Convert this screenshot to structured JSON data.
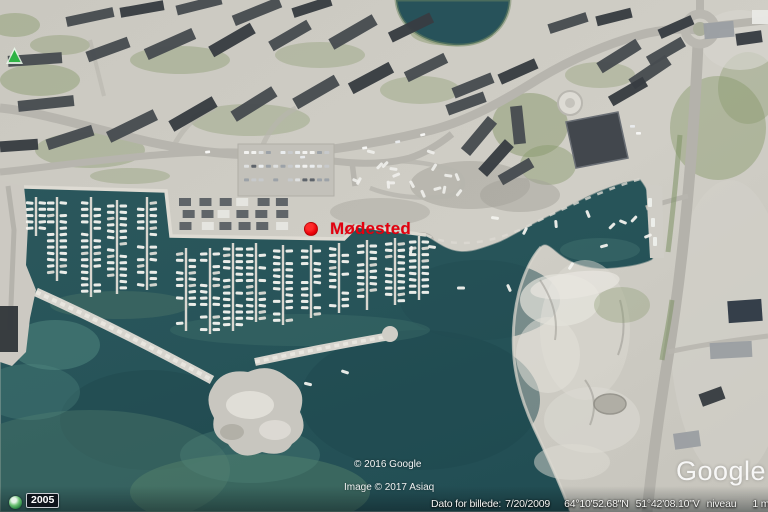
{
  "marker": {
    "label": "Mødested",
    "color": "#e3000f"
  },
  "placemark_triangle": {
    "icon": "green-triangle-placemark-icon",
    "color": "#2eb344"
  },
  "timeline": {
    "year_badge": "2005",
    "icon": "history-clock-icon"
  },
  "copyright": {
    "line1": "© 2016 Google",
    "line2": "Image © 2017 Asiaq"
  },
  "watermark": {
    "text": "Google E"
  },
  "status_bar": {
    "imagery_date_label": "Dato for billede:",
    "imagery_date": "7/20/2009",
    "latitude": "64°10'52.68\"N",
    "longitude": "51°42'08.10\"V",
    "elevation_label": "niveau",
    "elevation": "1 m",
    "eye_alt_label": "øjehøjde"
  },
  "scene_colors": {
    "water": "#275459",
    "land": "#cac8c0",
    "rock": "#e8e6df",
    "roof_dark": "#474c51",
    "road": "#b7b5ae",
    "boat": "#f4f4f0"
  }
}
